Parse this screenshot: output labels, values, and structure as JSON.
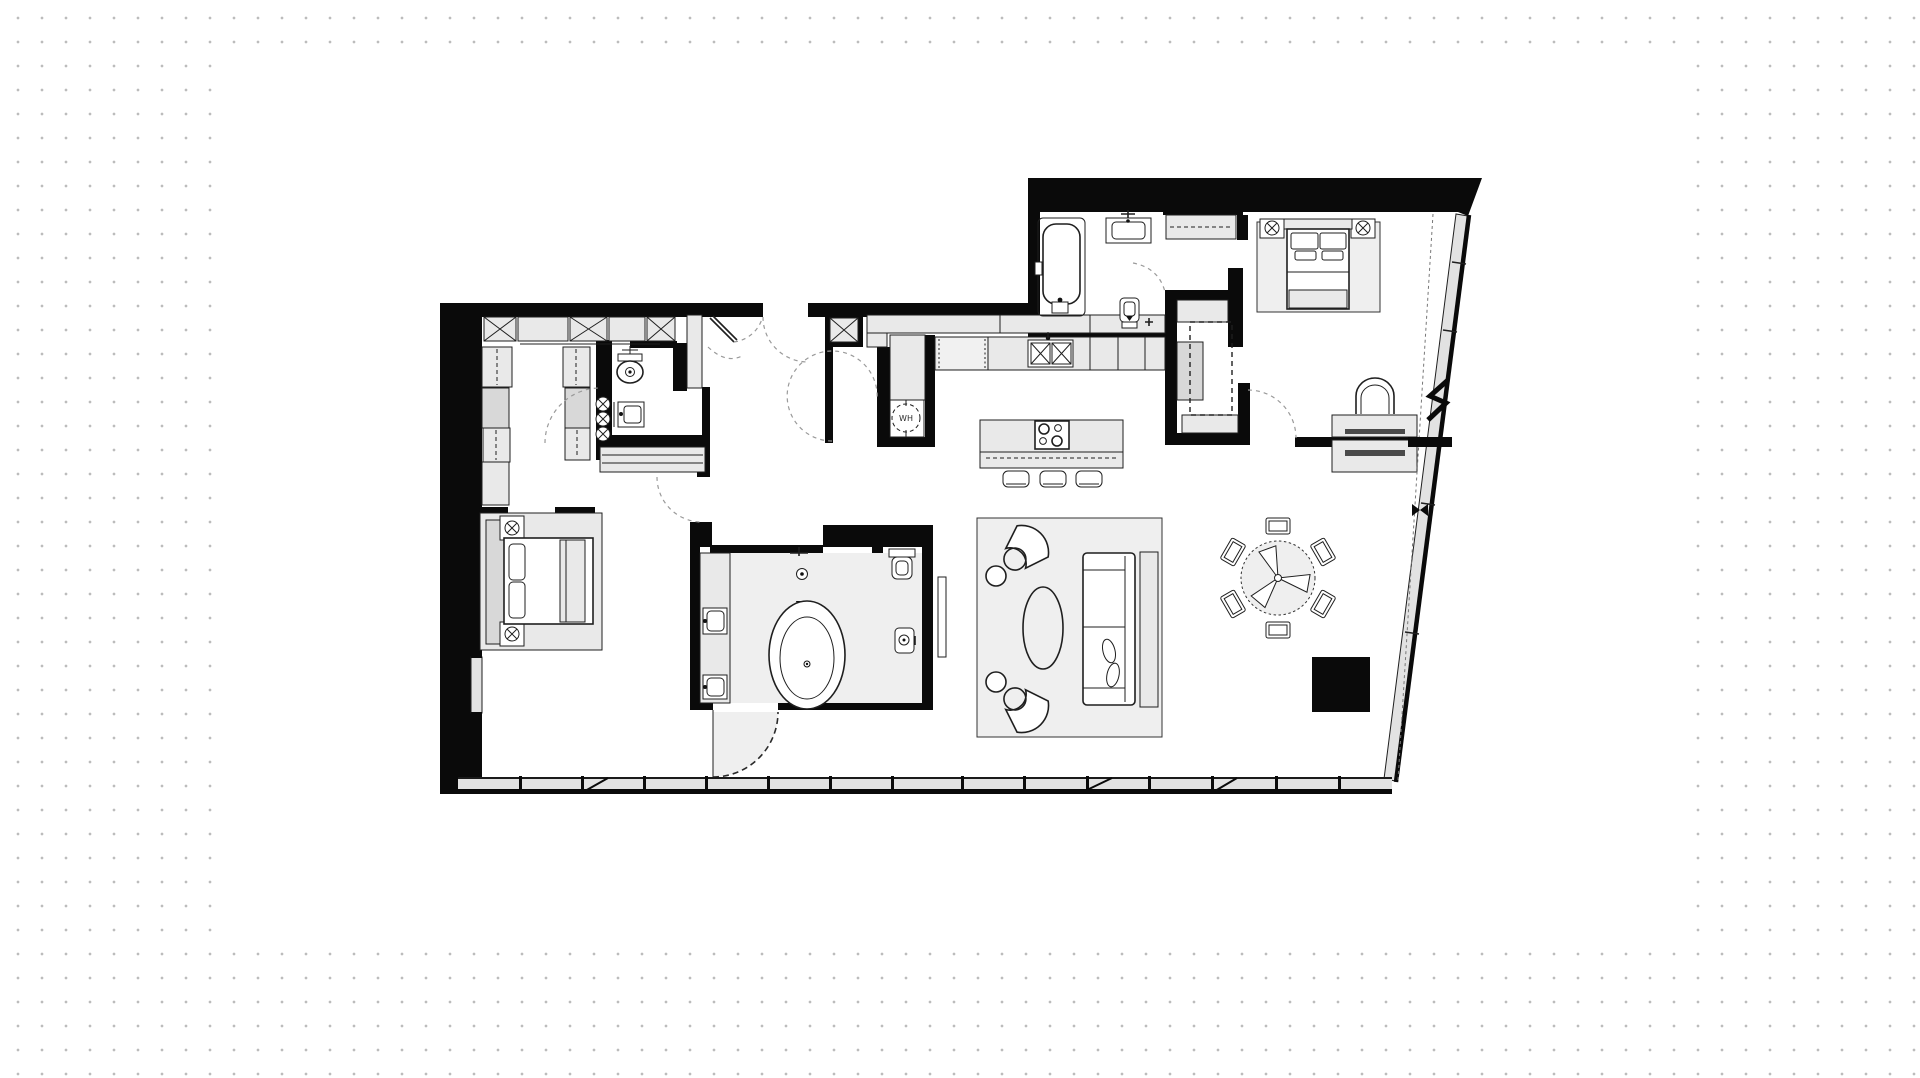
{
  "app": {
    "canvas_bg": "#ffffff",
    "dot": "#bcbcbc",
    "artboard": "#ffffff"
  },
  "colors": {
    "wall": "#0a0a0a",
    "line": "#1f1f1f",
    "fill_light": "#e9e9e9",
    "fill_mid": "#d8d8d8",
    "fill_glass": "#e2e2e2",
    "dash": "#9a9a9a",
    "floor": "#efefef",
    "dark_bar": "#4a4a4a"
  },
  "floor_plan": {
    "type": "apartment-floor-plan",
    "water_heater_label": "WH",
    "fixtures": [
      "walk-in-closet",
      "powder-room-toilet",
      "powder-room-sink",
      "entry-double-door",
      "water-heater",
      "kitchen-sink",
      "dishwasher",
      "island-cooktop",
      "bar-stools",
      "oval-bathtub",
      "double-vanity",
      "wall-hung-toilet",
      "bidet",
      "sofa",
      "accent-chairs",
      "coffee-table",
      "tv-console",
      "dining-table-6-chairs",
      "master-bed",
      "nightstand-lamps",
      "desk-with-chair",
      "master-bathtub",
      "master-vanity",
      "master-toilet",
      "glazed-facade",
      "window-band"
    ],
    "room_count_bedrooms": 2,
    "orientation": "right-facade-slanted"
  }
}
